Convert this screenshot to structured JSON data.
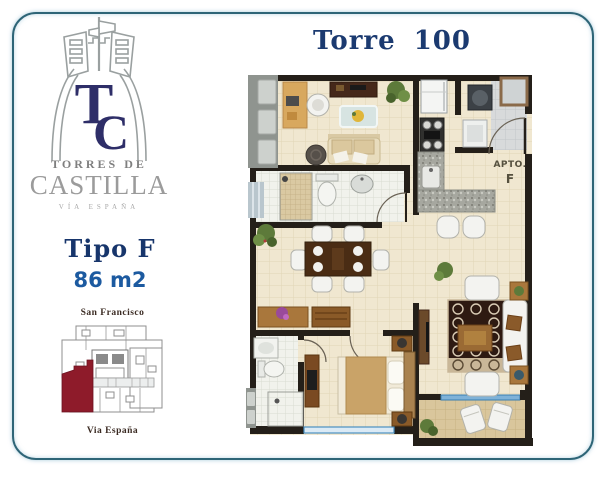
{
  "brand": {
    "monogram_t": "T",
    "monogram_c": "C",
    "name_line1": "TORRES DE",
    "name_line2": "CASTILLA",
    "tagline": "VÍA ESPAÑA"
  },
  "unit": {
    "type": "Tipo F",
    "area": "86 m2"
  },
  "location": {
    "north_label": "San Francisco",
    "south_label": "Via España",
    "highlight_color": "#8e1b2a"
  },
  "plan": {
    "title": "Torre 100",
    "apto_label": "APTO.",
    "apto_letter": "F"
  },
  "colors": {
    "frame_border": "#2e6577",
    "title_navy": "#1b3a70",
    "area_blue": "#1c5aa0",
    "logo_navy": "#2e2e68",
    "wall_dark": "#241f19",
    "floor_beige": "#f0e7d0"
  }
}
